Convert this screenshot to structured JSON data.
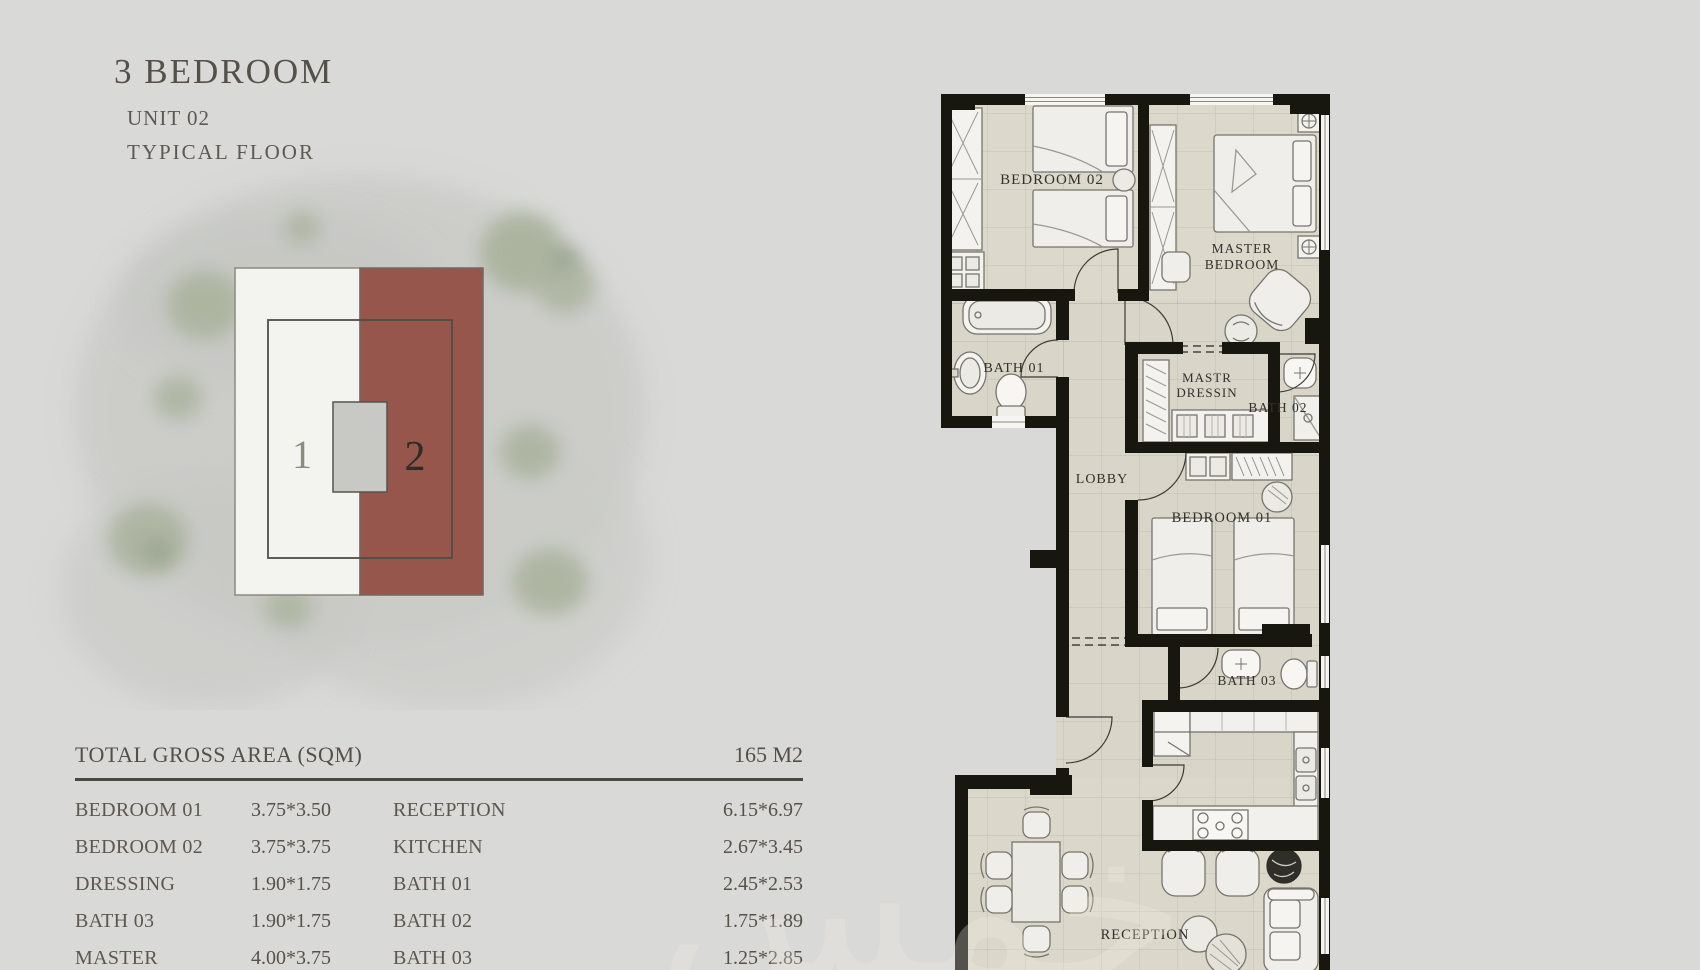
{
  "title_block": {
    "title": "3 BEDROOM",
    "unit": "UNIT 02",
    "floor": "TYPICAL FLOOR"
  },
  "site_plan": {
    "building_1_label": "1",
    "building_2_label": "2",
    "highlight_color": "#96564c"
  },
  "area_table": {
    "header": "TOTAL GROSS AREA  (SQM)",
    "total": "165 M2",
    "left_rows": [
      {
        "label": "BEDROOM 01",
        "dims": "3.75*3.50"
      },
      {
        "label": "BEDROOM 02",
        "dims": "3.75*3.75"
      },
      {
        "label": "DRESSING",
        "dims": "1.90*1.75"
      },
      {
        "label": "BATH 03",
        "dims": "1.90*1.75"
      },
      {
        "label": "MASTER BEDROOM",
        "dims": "4.00*3.75"
      }
    ],
    "right_rows": [
      {
        "label": "RECEPTION",
        "dims": "6.15*6.97"
      },
      {
        "label": "KITCHEN",
        "dims": "2.67*3.45"
      },
      {
        "label": "BATH 01",
        "dims": "2.45*2.53"
      },
      {
        "label": "BATH 02",
        "dims": "1.75*1.89"
      },
      {
        "label": "BATH 03",
        "dims": "1.25*2.85"
      }
    ]
  },
  "floor_plan": {
    "labels": {
      "bedroom02": "BEDROOM 02",
      "master1": "MASTER",
      "master2": "BEDROOM",
      "bath01": "BATH 01",
      "dressing1": "MASTR",
      "dressing2": "DRESSIN",
      "bath02": "BATH 02",
      "lobby": "LOBBY",
      "bedroom01": "BEDROOM 01",
      "bath03": "BATH 03",
      "reception": "RECEPTION"
    }
  },
  "watermark": "خمس"
}
